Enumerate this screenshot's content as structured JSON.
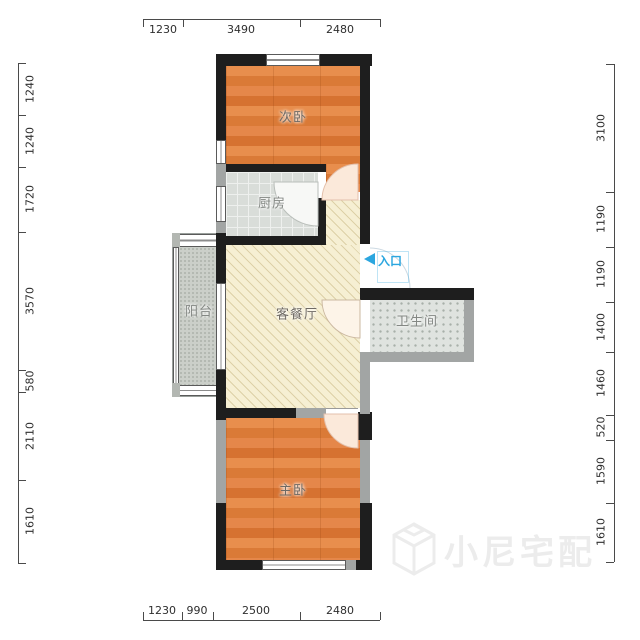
{
  "plan": {
    "rooms": [
      {
        "id": "secondary-bedroom",
        "label": "次卧",
        "floor": "wood"
      },
      {
        "id": "kitchen",
        "label": "厨房",
        "floor": "tile"
      },
      {
        "id": "living-dining",
        "label": "客餐厅",
        "floor": "diagonal-hatch"
      },
      {
        "id": "balcony",
        "label": "阳台",
        "floor": "stipple"
      },
      {
        "id": "bathroom",
        "label": "卫生间",
        "floor": "dots"
      },
      {
        "id": "master-bedroom",
        "label": "主卧",
        "floor": "wood"
      }
    ],
    "entrance": {
      "label": "入口",
      "arrow_direction": "left"
    }
  },
  "dimensions": {
    "top": [
      "1230",
      "3490",
      "2480"
    ],
    "bottom": [
      "1230",
      "990",
      "2500",
      "2480"
    ],
    "left": [
      "1240",
      "1240",
      "1720",
      "3570",
      "580",
      "2110",
      "1610"
    ],
    "right": [
      "3100",
      "1190",
      "1190",
      "1400",
      "1460",
      "520",
      "1590",
      "1610"
    ]
  },
  "watermark": {
    "text": "小尼宅配",
    "icon": "cube-logo"
  },
  "colors": {
    "wall": "#1e1e1e",
    "wall_light": "#a2a5a4",
    "wood_floor": "#e0813f",
    "tile_floor": "#d9ddd9",
    "living_floor": "#f6efd3",
    "entry_accent": "#2ba6df",
    "dimension_text": "#2e2e2e",
    "watermark_gray": "#ececec"
  }
}
